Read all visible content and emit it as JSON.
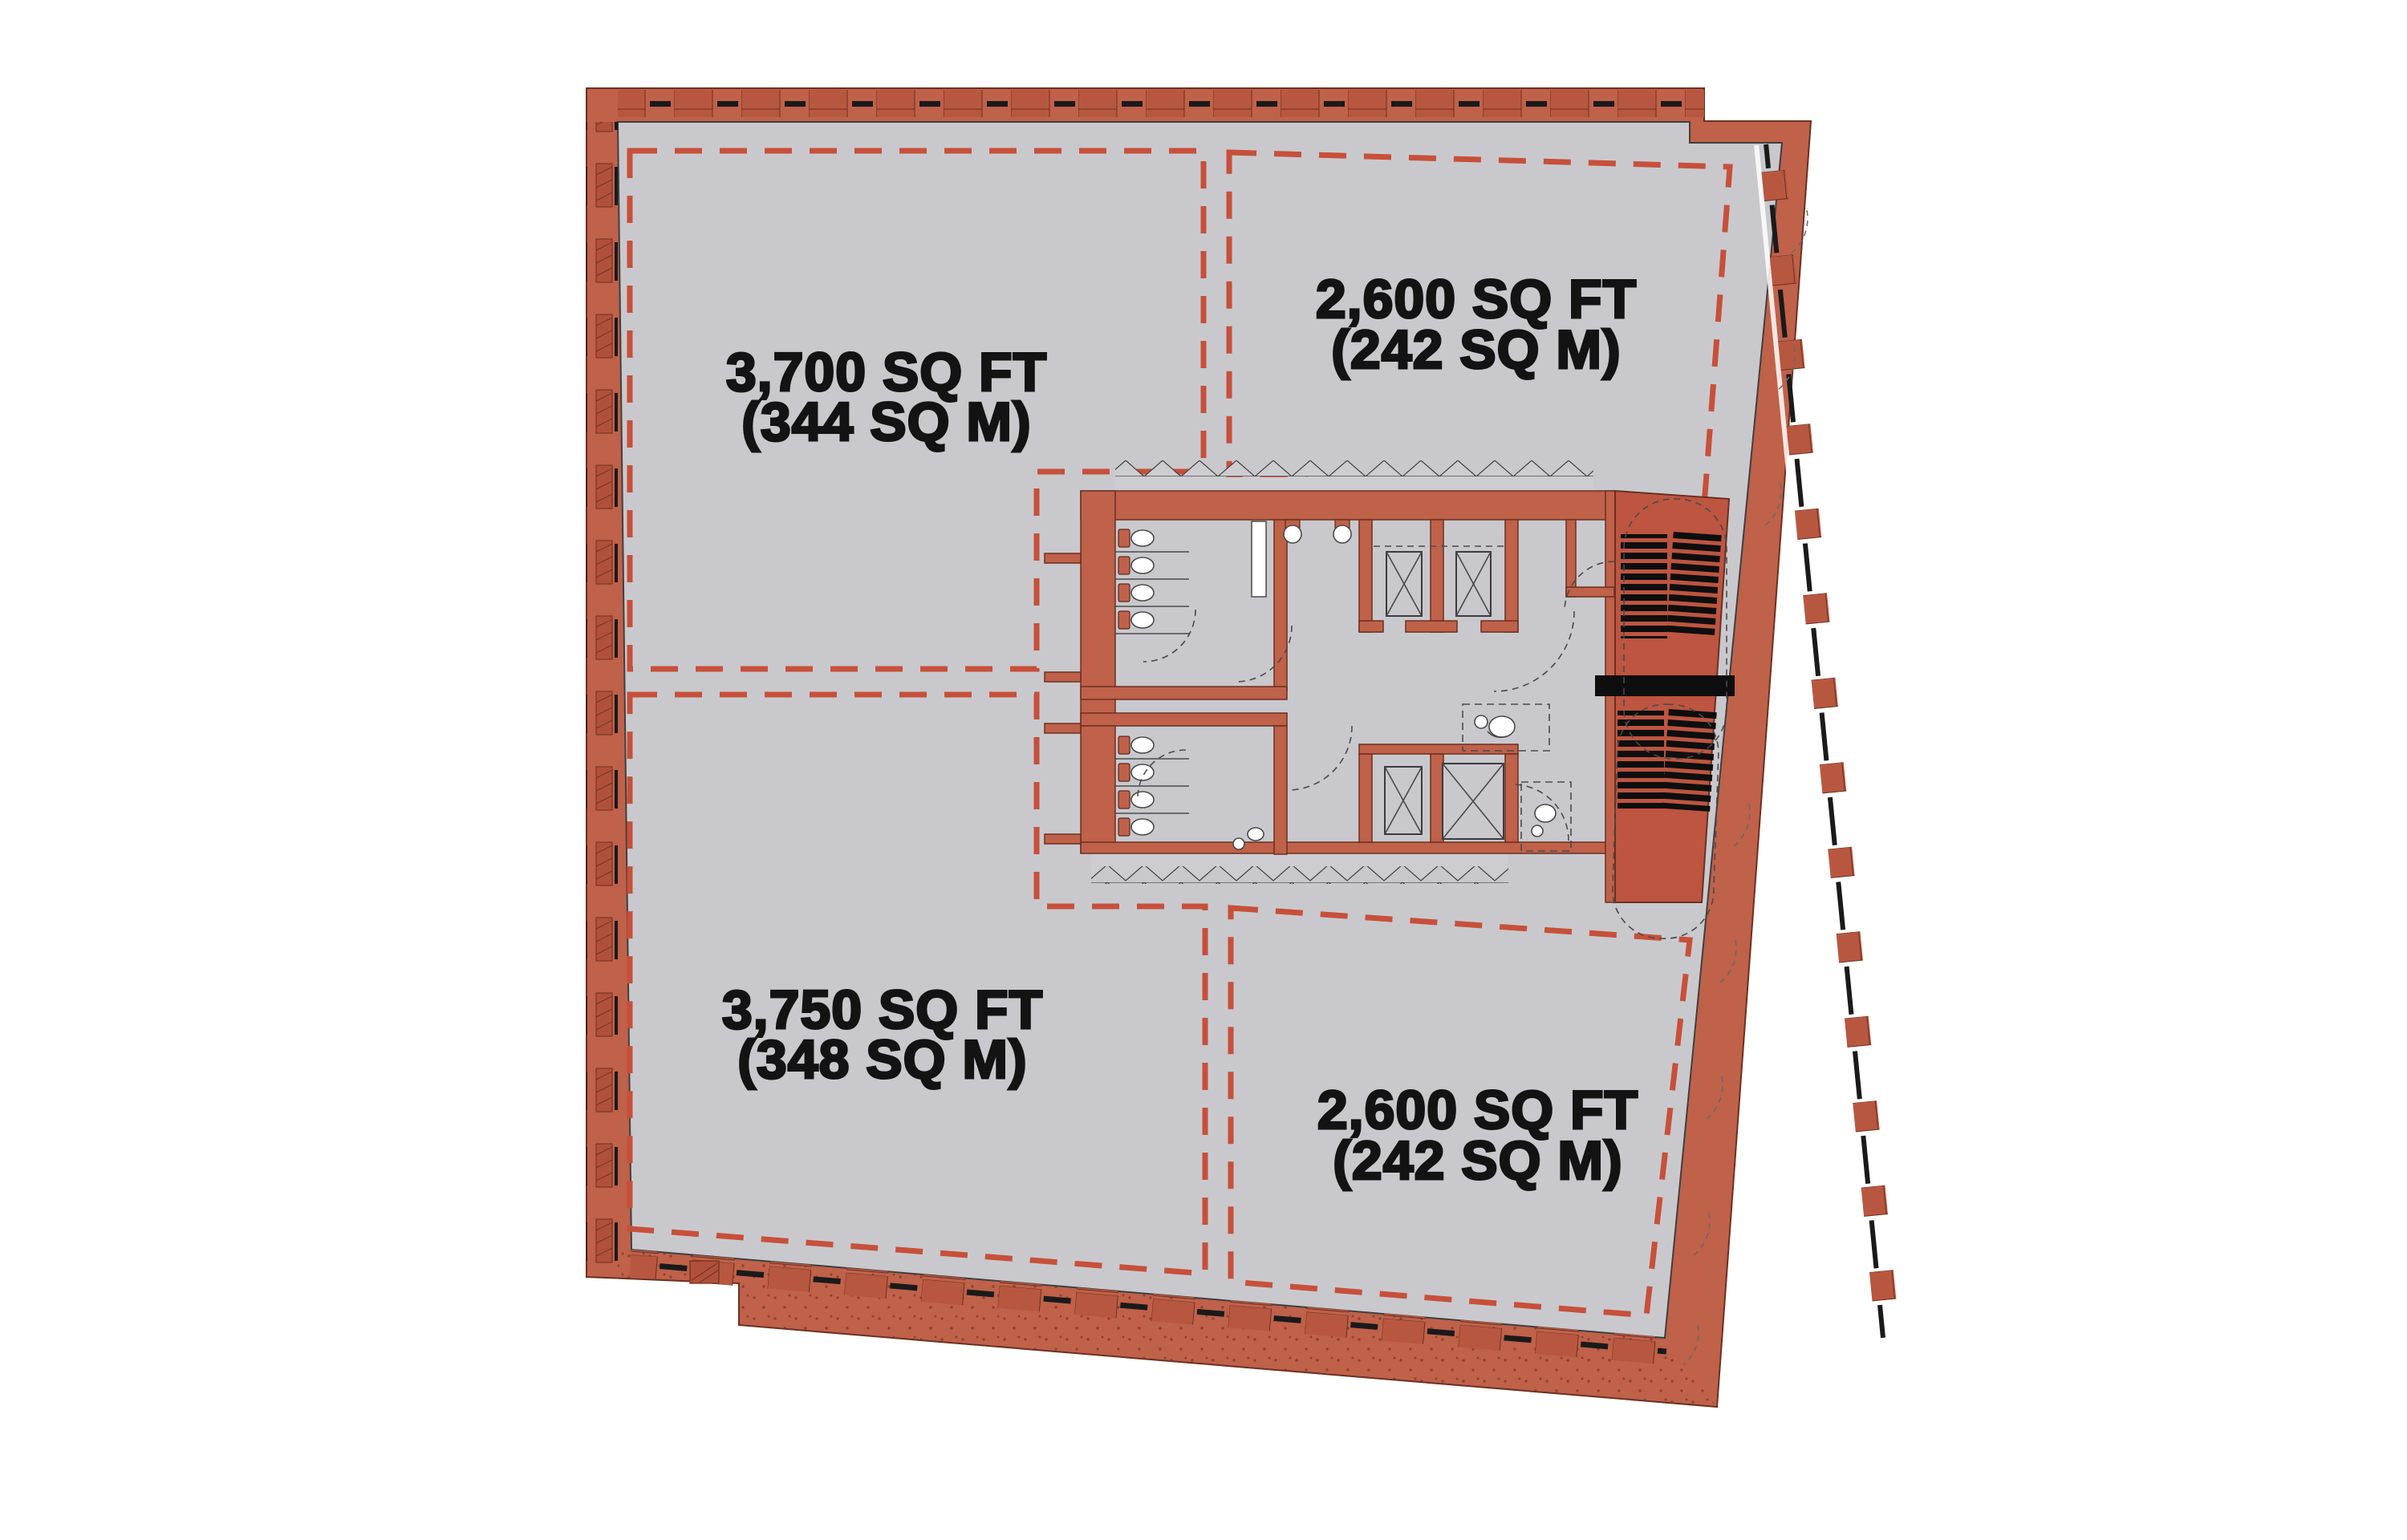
{
  "suites": [
    {
      "id": "top-left",
      "area_sqft": "3,700 SQ FT",
      "area_sqm": "(344 SQ M)"
    },
    {
      "id": "top-right",
      "area_sqft": "2,600 SQ FT",
      "area_sqm": "(242 SQ M)"
    },
    {
      "id": "bottom-left",
      "area_sqft": "3,750 SQ FT",
      "area_sqm": "(348 SQ M)"
    },
    {
      "id": "bottom-right",
      "area_sqft": "2,600 SQ FT",
      "area_sqm": "(242 SQ M)"
    }
  ],
  "symbols": {
    "elevator_icon": "crossed-box-lift-shaft",
    "stair_icon": "black-tread-stripes",
    "toilet_icon": "plan-view-wc-pan",
    "sink_icon": "plan-view-basin",
    "accessible_wc_icon": "dashed-box-accessible-wc",
    "window_icon": "zigzag-and-mullion-ticks",
    "door_icon": "dashed-quarter-circle-swing"
  },
  "colors": {
    "wall": "#c0614a",
    "wall2": "#bd5540",
    "wall_dark": "#b1503a",
    "floor": "#c9c9cd",
    "sill": "#cdcdd1",
    "demise": "#c7503a",
    "outline": "#6b3020",
    "tread": "#0e0e0e",
    "text": "#131313",
    "background": "#ffffff"
  }
}
